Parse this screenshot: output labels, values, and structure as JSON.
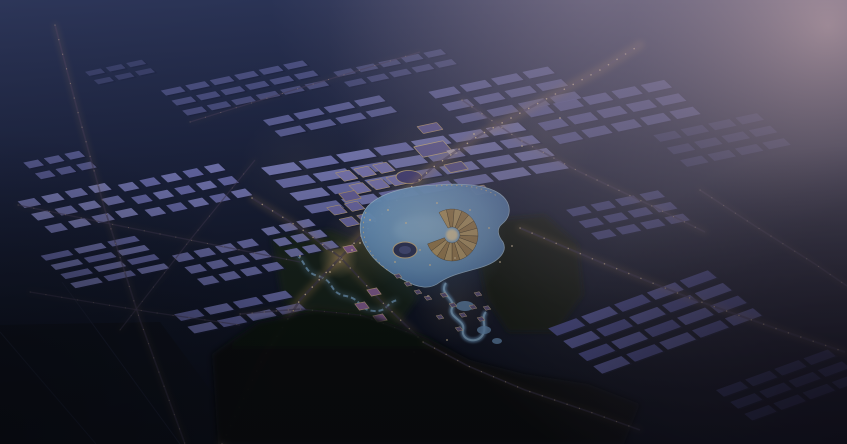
{
  "meta": {
    "description": "Night aerial architectural rendering of a masterplan city with illuminated central lake district, warehouse fields and industrial blocks",
    "width": 847,
    "height": 444
  },
  "palette": {
    "sky_top": "#2d3659",
    "sky_mid": "#212948",
    "sky_low": "#141a2e",
    "sky_bottom": "#0d101d",
    "haze_core": "#a8929e",
    "haze_mid": "#8d7f92",
    "top_fade": "#8f8298",
    "roof_shadow": "#1c2040",
    "road_base": "#4a4260",
    "road_glow": "#c79a5f",
    "street_light": "#ffe2ad",
    "lake_core": "#a6d2f4",
    "lake_mid": "#7fb2e4",
    "lake_edge": "#4f7fc2",
    "lake_stroke": "#bfe0f8",
    "warm_glow": "#f3cd8e",
    "blue_glow": "#7fb9ea",
    "forest_top": "#0e140f",
    "forest_bottom": "#070b08",
    "park_left": "#1e2c1a",
    "park_right": "#131f0e",
    "river": "#8fc0ea",
    "vignette": "#04060a",
    "corner_dark": "#191325",
    "amph_a": "#d8b77a",
    "amph_b": "#bb9760",
    "amph_rim": "#f0d6a0",
    "amph_core": "#ffedc2",
    "amph_line": "#5a4a30",
    "island_fill": "#3a4168",
    "island_stroke": "#e9cf9e",
    "island_core": "#565f94",
    "cottage_fill": "#6e6193",
    "cottage_stroke": "#f2d4a2",
    "pink_fill": "#a272b0",
    "pink_stroke": "#f0c8a0",
    "dot": "#ffe6b8",
    "field_line": "#232942",
    "field_fill": "#10141f"
  },
  "scene": {
    "fields": {
      "poly": [
        [
          0,
          325
        ],
        [
          160,
          322
        ],
        [
          250,
          444
        ],
        [
          0,
          444
        ]
      ],
      "lines": [
        [
          [
            62,
            282
          ],
          [
            180,
            444
          ]
        ],
        [
          [
            0,
            332
          ],
          [
            96,
            444
          ]
        ]
      ]
    },
    "parks": [
      {
        "name": "park-west",
        "fill": "park_left",
        "pts": [
          [
            272,
            238
          ],
          [
            330,
            230
          ],
          [
            398,
            258
          ],
          [
            418,
            298
          ],
          [
            396,
            328
          ],
          [
            330,
            330
          ],
          [
            283,
            302
          ]
        ]
      },
      {
        "name": "park-east",
        "fill": "park_right",
        "pts": [
          [
            490,
            220
          ],
          [
            545,
            215
          ],
          [
            578,
            244
          ],
          [
            583,
            295
          ],
          [
            556,
            332
          ],
          [
            508,
            332
          ],
          [
            486,
            298
          ],
          [
            478,
            258
          ]
        ]
      }
    ],
    "river": {
      "path": "M290,250 C308,260 302,272 318,276 C336,281 328,293 346,296 C362,299 358,310 374,311 C388,312 386,302 398,300"
    },
    "glows": [
      {
        "x": 420,
        "y": 200,
        "r": 85,
        "kind": "warm",
        "o": 0.16
      },
      {
        "x": 365,
        "y": 245,
        "r": 45,
        "kind": "warm",
        "o": 0.2
      },
      {
        "x": 338,
        "y": 259,
        "r": 20,
        "kind": "warm",
        "o": 0.5
      },
      {
        "x": 455,
        "y": 305,
        "r": 42,
        "kind": "warm",
        "o": 0.14
      },
      {
        "x": 545,
        "y": 135,
        "r": 55,
        "kind": "warm",
        "o": 0.1
      },
      {
        "x": 300,
        "y": 168,
        "r": 60,
        "kind": "warm",
        "o": 0.07
      },
      {
        "x": 435,
        "y": 238,
        "r": 72,
        "kind": "blue",
        "o": 0.4
      }
    ],
    "clusters": [
      {
        "name": "left-grid-a",
        "x": 78,
        "y": 208,
        "cols": 4,
        "rows": 3,
        "cw": 17,
        "ch": 8,
        "gx": 7,
        "gy": 7,
        "fill": "#7e81c4",
        "fill2": "#8c8fd0"
      },
      {
        "name": "left-grid-b",
        "x": 185,
        "y": 190,
        "cols": 5,
        "rows": 3,
        "cw": 15,
        "ch": 8,
        "gx": 7,
        "gy": 7,
        "fill": "#8285c8",
        "fill2": "#7477bd"
      },
      {
        "name": "left-slab-yard",
        "x": 105,
        "y": 262,
        "cols": 3,
        "rows": 4,
        "cw": 28,
        "ch": 6,
        "gx": 6,
        "gy": 5,
        "fill": "#7477bd",
        "fill2": "#8285c8"
      },
      {
        "name": "left-grid-c",
        "x": 228,
        "y": 262,
        "cols": 4,
        "rows": 3,
        "cw": 16,
        "ch": 8,
        "gx": 6,
        "gy": 6,
        "fill": "#7b7ec2"
      },
      {
        "name": "left-warehouse-row",
        "x": 240,
        "y": 312,
        "cols": 4,
        "rows": 2,
        "cw": 24,
        "ch": 8,
        "gx": 6,
        "gy": 7,
        "fill": "#7073bc",
        "fill2": "#7d80c6"
      },
      {
        "name": "mid-residential",
        "x": 300,
        "y": 238,
        "cols": 3,
        "rows": 3,
        "cw": 13,
        "ch": 8,
        "gx": 5,
        "gy": 5,
        "fill": "#8588c9"
      },
      {
        "name": "left-edge-blocks",
        "x": 60,
        "y": 165,
        "cols": 3,
        "rows": 2,
        "cw": 15,
        "ch": 7,
        "gx": 6,
        "gy": 6,
        "fill": "#6f72b4",
        "opacity": 0.85
      },
      {
        "name": "distant-rows-a",
        "x": 245,
        "y": 88,
        "cols": 6,
        "rows": 3,
        "cw": 20,
        "ch": 6,
        "gx": 5,
        "gy": 6,
        "fill": "#6b6eae",
        "opacity": 0.6
      },
      {
        "name": "distant-rows-b",
        "x": 120,
        "y": 72,
        "cols": 3,
        "rows": 2,
        "cw": 16,
        "ch": 5,
        "gx": 5,
        "gy": 5,
        "fill": "#62659f",
        "opacity": 0.4
      },
      {
        "name": "distant-rows-c",
        "x": 395,
        "y": 68,
        "cols": 5,
        "rows": 2,
        "cw": 18,
        "ch": 6,
        "gx": 5,
        "gy": 6,
        "fill": "#6e71b2",
        "opacity": 0.5
      },
      {
        "name": "warehouse-field",
        "x": 415,
        "y": 168,
        "cols": 7,
        "rows": 4,
        "cw": 33,
        "ch": 9,
        "gx": 5,
        "gy": 6,
        "fill": "#8a8dd0",
        "fill2": "#7e81c6",
        "angle": -10,
        "skew": 38,
        "opacity": 0.97
      },
      {
        "name": "warehouse-field-nw",
        "x": 330,
        "y": 116,
        "cols": 4,
        "rows": 2,
        "cw": 26,
        "ch": 7,
        "gx": 5,
        "gy": 6,
        "fill": "#7a7dc0",
        "opacity": 0.75
      },
      {
        "name": "warehouse-field-ne",
        "x": 505,
        "y": 95,
        "cols": 4,
        "rows": 3,
        "cw": 26,
        "ch": 8,
        "gx": 6,
        "gy": 7,
        "fill": "#7578bc",
        "opacity": 0.8
      },
      {
        "name": "east-industrial-a",
        "x": 612,
        "y": 112,
        "cols": 5,
        "rows": 3,
        "cw": 24,
        "ch": 9,
        "gx": 6,
        "gy": 7,
        "fill": "#6f72bb",
        "opacity": 0.85
      },
      {
        "name": "east-industrial-b",
        "x": 722,
        "y": 140,
        "cols": 4,
        "rows": 3,
        "cw": 22,
        "ch": 8,
        "gx": 6,
        "gy": 7,
        "fill": "#5b5ea6",
        "opacity": 0.5
      },
      {
        "name": "east-mid-grid",
        "x": 628,
        "y": 215,
        "cols": 4,
        "rows": 3,
        "cw": 19,
        "ch": 8,
        "gx": 6,
        "gy": 6,
        "fill": "#6164ae",
        "opacity": 0.8
      },
      {
        "name": "southeast-industrial-a",
        "x": 655,
        "y": 322,
        "cols": 5,
        "rows": 4,
        "cw": 30,
        "ch": 10,
        "gx": 5,
        "gy": 7,
        "fill": "#5c5fb2",
        "fill2": "#6b6ec0",
        "angle": -20,
        "skew": 30,
        "opacity": 0.95
      },
      {
        "name": "southeast-industrial-b",
        "x": 790,
        "y": 385,
        "cols": 4,
        "rows": 3,
        "cw": 26,
        "ch": 9,
        "gx": 5,
        "gy": 7,
        "fill": "#4c4f9a",
        "angle": -20,
        "skew": 30,
        "opacity": 0.7
      },
      {
        "name": "downtown-block-a",
        "x": 372,
        "y": 178,
        "cols": 3,
        "rows": 2,
        "cw": 14,
        "ch": 10,
        "gx": 5,
        "gy": 5,
        "fill": "#8d89cc",
        "stroke": "#d9bc8e"
      },
      {
        "name": "downtown-block-b",
        "x": 352,
        "y": 214,
        "cols": 2,
        "rows": 2,
        "cw": 13,
        "ch": 9,
        "gx": 5,
        "gy": 5,
        "fill": "#7f7bc0",
        "stroke": "#d9bc8e"
      }
    ],
    "singles": [
      {
        "name": "civic-hall",
        "x": 433,
        "y": 149,
        "w": 30,
        "h": 12,
        "fill": "#6f68a8",
        "stroke": "#e7ca96"
      },
      {
        "name": "bright-roof",
        "x": 452,
        "y": 152,
        "w": 8,
        "h": 5,
        "fill": "#d9d2ee"
      },
      {
        "name": "north-pavilion",
        "x": 430,
        "y": 128,
        "w": 20,
        "h": 8,
        "fill": "#6b64a4",
        "stroke": "#caa980"
      },
      {
        "name": "hotel-block",
        "x": 456,
        "y": 167,
        "w": 18,
        "h": 9,
        "fill": "#6a629f",
        "stroke": "#dcbf90"
      },
      {
        "name": "oval-court",
        "type": "ellipse",
        "x": 409,
        "y": 177,
        "rx": 12,
        "ry": 7,
        "fill": "#4c4686",
        "stroke": "#d8bc8c"
      },
      {
        "name": "plaza-block",
        "x": 350,
        "y": 196,
        "w": 16,
        "h": 9,
        "fill": "#776fb0",
        "stroke": "#caa980"
      },
      {
        "name": "east-pavilion",
        "x": 480,
        "y": 190,
        "w": 14,
        "h": 8,
        "fill": "#6a5f9c",
        "stroke": "#d8b888"
      }
    ],
    "roads": [
      {
        "name": "west-lane",
        "pts": [
          [
            55,
            25
          ],
          [
            80,
            120
          ],
          [
            105,
            210
          ],
          [
            140,
            320
          ],
          [
            185,
            444
          ]
        ],
        "bw": 1.6,
        "gw": 5,
        "go": 0.12,
        "lw": 1.1,
        "dash": 15,
        "lo": 0.4
      },
      {
        "name": "main-arterial",
        "pts": [
          [
            222,
            444
          ],
          [
            262,
            360
          ],
          [
            300,
            300
          ],
          [
            338,
            260
          ],
          [
            382,
            214
          ],
          [
            432,
            168
          ],
          [
            478,
            136
          ],
          [
            535,
            105
          ],
          [
            600,
            70
          ],
          [
            640,
            45
          ]
        ],
        "bw": 2.4,
        "gw": 9,
        "go": 0.3,
        "lw": 1.5,
        "dash": 10,
        "lo": 0.95
      },
      {
        "name": "south-diagonal",
        "pts": [
          [
            252,
            198
          ],
          [
            300,
            228
          ],
          [
            340,
            257
          ],
          [
            380,
            300
          ],
          [
            423,
            342
          ]
        ],
        "bw": 2,
        "gw": 7,
        "go": 0.2,
        "lw": 1.4,
        "dash": 12,
        "lo": 0.7
      },
      {
        "name": "forest-road",
        "pts": [
          [
            423,
            342
          ],
          [
            468,
            366
          ],
          [
            525,
            390
          ],
          [
            590,
            412
          ],
          [
            640,
            430
          ]
        ],
        "bw": 1.6,
        "gw": 5,
        "go": 0.1,
        "lw": 1.2,
        "dash": 13,
        "lo": 0.55,
        "above_forest": true
      },
      {
        "name": "south-boulevard",
        "pts": [
          [
            240,
            314
          ],
          [
            300,
            309
          ],
          [
            360,
            315
          ],
          [
            412,
            334
          ]
        ],
        "bw": 1.6,
        "gw": 5,
        "go": 0.12,
        "lw": 1.1,
        "dash": 12,
        "lo": 0.5
      },
      {
        "name": "east-road",
        "pts": [
          [
            520,
            228
          ],
          [
            600,
            262
          ],
          [
            690,
            298
          ],
          [
            780,
            330
          ],
          [
            845,
            352
          ]
        ],
        "bw": 2,
        "gw": 7,
        "go": 0.2,
        "lw": 1.4,
        "dash": 13,
        "lo": 0.8
      },
      {
        "name": "far-east-road",
        "pts": [
          [
            700,
            190
          ],
          [
            755,
            226
          ],
          [
            815,
            264
          ],
          [
            847,
            286
          ]
        ],
        "bw": 1.6,
        "gw": 5,
        "go": 0.12,
        "lw": 1.1,
        "dash": 14,
        "lo": 0.5
      },
      {
        "name": "cross-route",
        "pts": [
          [
            462,
            100
          ],
          [
            520,
            140
          ],
          [
            580,
            172
          ],
          [
            650,
            205
          ],
          [
            705,
            232
          ]
        ],
        "bw": 1.6,
        "gw": 6,
        "go": 0.15,
        "lw": 1.2,
        "dash": 12,
        "lo": 0.6
      },
      {
        "name": "grid-street-a",
        "pts": [
          [
            18,
            205
          ],
          [
            150,
            232
          ],
          [
            300,
            262
          ]
        ],
        "bw": 1.4,
        "gw": 4,
        "go": 0.08,
        "lw": 1,
        "dash": 16,
        "lo": 0.4
      },
      {
        "name": "grid-street-b",
        "pts": [
          [
            30,
            292
          ],
          [
            150,
            312
          ],
          [
            240,
            325
          ]
        ],
        "bw": 1.2,
        "gw": 4,
        "go": 0.06,
        "lw": 1,
        "dash": 16,
        "lo": 0.3
      },
      {
        "name": "grid-street-c",
        "pts": [
          [
            120,
            330
          ],
          [
            190,
            240
          ],
          [
            255,
            160
          ]
        ],
        "bw": 1.2,
        "gw": 4,
        "go": 0.06,
        "lw": 1,
        "dash": 18,
        "lo": 0.25
      },
      {
        "name": "north-lane",
        "pts": [
          [
            190,
            122
          ],
          [
            300,
            88
          ],
          [
            420,
            52
          ]
        ],
        "bw": 1.2,
        "gw": 4,
        "go": 0.06,
        "lw": 1,
        "dash": 16,
        "lo": 0.3
      }
    ],
    "water": {
      "lake_path": "M368,206 C382,192 408,186 436,185 C458,183 486,184 500,194 C512,203 512,216 502,224 C496,229 498,236 503,242 C508,252 498,262 482,267 C466,272 452,274 440,282 C430,290 418,288 404,280 C388,272 372,260 364,244 C358,232 359,216 368,206 Z",
      "highlight": {
        "x": 424,
        "y": 230,
        "rx": 30,
        "ry": 14,
        "o": 0.5
      },
      "canal_path": "M446,283 C438,294 456,298 452,308 C448,318 466,320 463,330 C461,340 476,344 482,336 C488,328 480,318 486,312",
      "ponds": [
        [
          465,
          306,
          9,
          5
        ],
        [
          484,
          330,
          7,
          4
        ],
        [
          497,
          341,
          5,
          3
        ]
      ],
      "promenades": [
        "M366,212 C358,234 368,256 390,272",
        "M436,186 C458,184 482,186 497,196"
      ]
    },
    "island": {
      "cx": 405,
      "cy": 250,
      "rx": 12,
      "ry": 8,
      "irx": 6,
      "iry": 4
    },
    "amphitheater": {
      "cx": 452,
      "cy": 235,
      "r1": 8,
      "r2": 26,
      "start": 240,
      "end": 520,
      "segs": 16
    },
    "cottages": [
      [
        444,
        295
      ],
      [
        453,
        305
      ],
      [
        463,
        315
      ],
      [
        473,
        307
      ],
      [
        481,
        319
      ],
      [
        459,
        329
      ],
      [
        440,
        317
      ],
      [
        478,
        294
      ],
      [
        487,
        308
      ],
      [
        398,
        276
      ],
      [
        408,
        284
      ],
      [
        418,
        292
      ],
      [
        428,
        298
      ]
    ],
    "pink_buildings": [
      [
        350,
        249
      ],
      [
        374,
        292
      ],
      [
        362,
        306
      ],
      [
        380,
        318
      ]
    ],
    "dots": [
      [
        352,
        250
      ],
      [
        360,
        243
      ],
      [
        406,
        223
      ],
      [
        388,
        210
      ],
      [
        420,
        250
      ],
      [
        430,
        265
      ],
      [
        395,
        262
      ],
      [
        370,
        220
      ],
      [
        437,
        203
      ],
      [
        470,
        210
      ],
      [
        489,
        228
      ],
      [
        455,
        258
      ],
      [
        428,
        296
      ],
      [
        447,
        340
      ],
      [
        414,
        352
      ],
      [
        500,
        262
      ],
      [
        512,
        246
      ],
      [
        340,
        262
      ],
      [
        330,
        272
      ],
      [
        300,
        256
      ],
      [
        522,
        146
      ],
      [
        474,
        134
      ],
      [
        560,
        118
      ]
    ],
    "forest": {
      "pts": [
        [
          212,
          354
        ],
        [
          258,
          322
        ],
        [
          316,
          310
        ],
        [
          372,
          316
        ],
        [
          428,
          338
        ],
        [
          470,
          360
        ],
        [
          524,
          374
        ],
        [
          588,
          384
        ],
        [
          640,
          404
        ],
        [
          624,
          444
        ],
        [
          218,
          444
        ]
      ]
    }
  }
}
